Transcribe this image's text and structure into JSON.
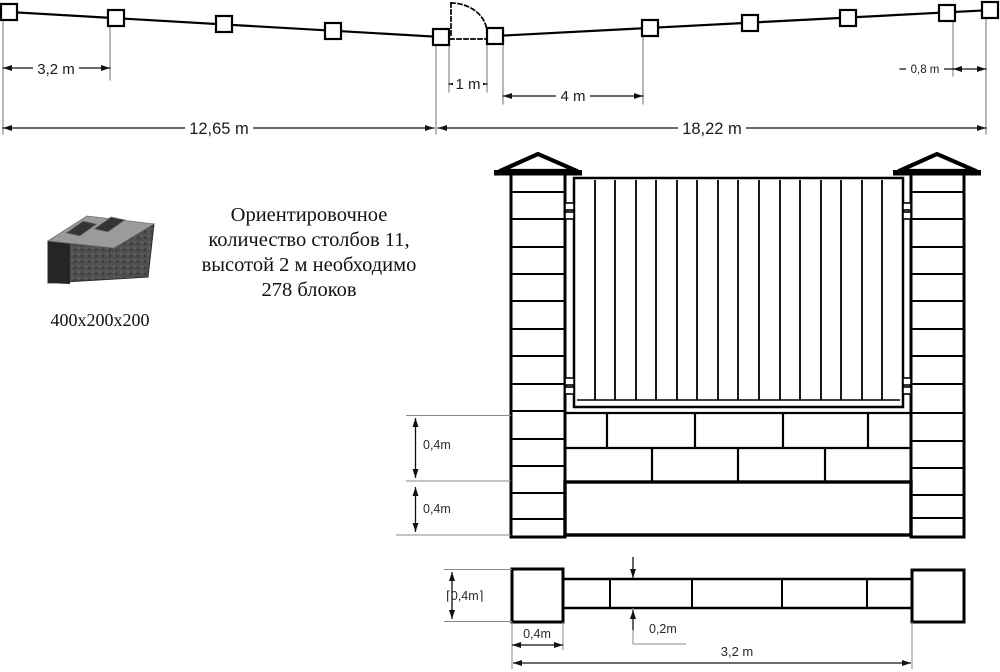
{
  "plan_view": {
    "dim_post_spacing": "3,2 m",
    "dim_left_total": "12,65 m",
    "dim_gate_opening": "1 m",
    "dim_after_gate": "4 m",
    "dim_right_total": "18,22 m",
    "dim_last_spacing": "0,8 m"
  },
  "block": {
    "size_label": "400x200x200",
    "image": "two-cell-concrete-block"
  },
  "note": {
    "lines": [
      "Ориентировочное",
      "количество столбов 11,",
      "высотой 2 м необходимо",
      "278 блоков"
    ]
  },
  "elevation": {
    "dim_masonry_height": "0,4m",
    "dim_foundation_height": "0,4m"
  },
  "plan_section": {
    "dim_post_depth": "⌈0,4m⌉",
    "dim_post_width": "0,4m",
    "dim_wall_thickness": "0,2m",
    "dim_span": "3,2 m"
  },
  "colors": {
    "line": "#000000",
    "dimension": "#1b1b1b",
    "extension": "#8a8a8a",
    "block_top": "#9b9b9b",
    "block_front": "#4f4f4f",
    "block_end": "#252525"
  }
}
